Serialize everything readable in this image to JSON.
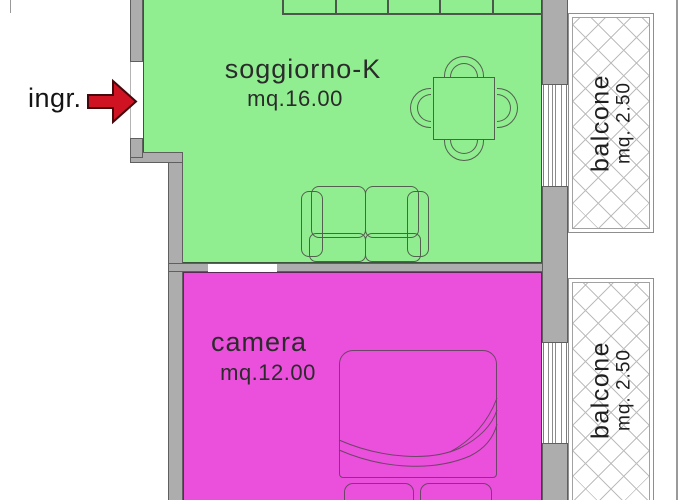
{
  "plan": {
    "entrance": {
      "label": "ingr."
    },
    "rooms": [
      {
        "id": "soggiorno",
        "name": "soggiorno-K",
        "area": "mq.16.00",
        "fill_color": "#90EE90"
      },
      {
        "id": "camera",
        "name": "camera",
        "area": "mq.12.00",
        "fill_color": "#EA50DC"
      }
    ],
    "balconies": [
      {
        "name": "balcone",
        "area": "mq. 2.50"
      },
      {
        "name": "balcone",
        "area": "mq. 2.50"
      }
    ],
    "colors": {
      "wall_gray": "#ADADAD",
      "arrow_red": "#D01323",
      "hatch_line": "#BDBDBD",
      "text": "#2B2B2B"
    }
  }
}
